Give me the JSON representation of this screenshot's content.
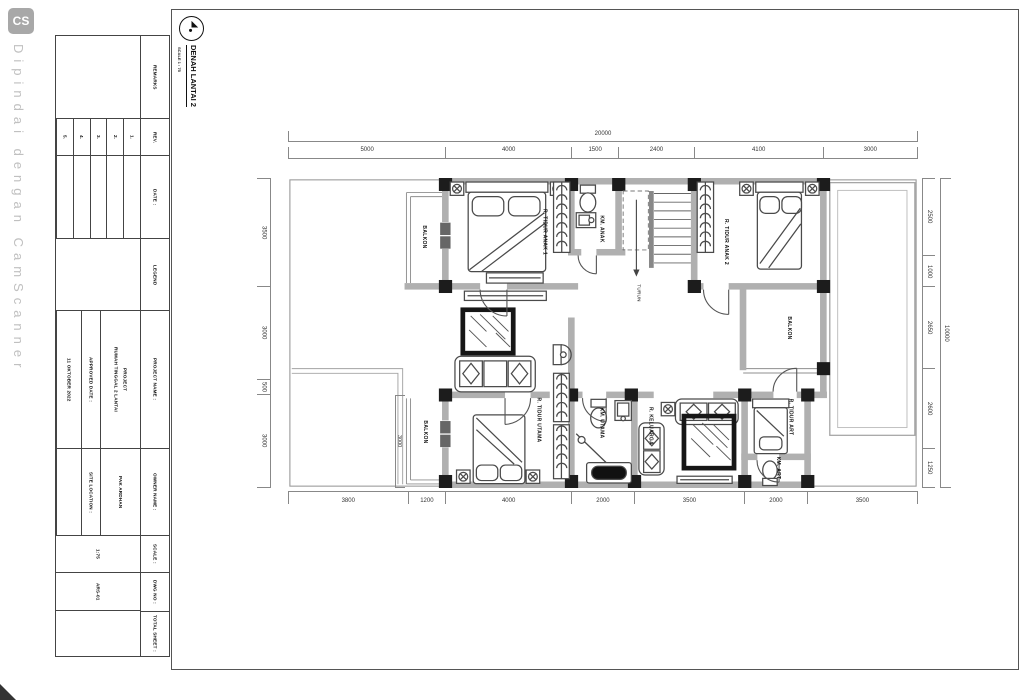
{
  "watermark": {
    "badge": "CS",
    "caption": "Dipindai dengan CamScanner"
  },
  "drawing_header": {
    "title": "DENAH LANTAI 2",
    "scale_note": "SCALE 1 : 75"
  },
  "title_block": {
    "remarks_label": "REMARKS",
    "rev_label": "REV.",
    "rev_numbers": [
      "1.",
      "2.",
      "3.",
      "4.",
      "5."
    ],
    "date_label": "DATE :",
    "legend_label": "LEGEND",
    "project_name_label": "PROJECT NAME :",
    "project_line1": "PROJECT",
    "project_line2": "RUMAH TINGGAL 2 LANTAI",
    "approved_date_label": "APPROVED DATE :",
    "approved_date_value": "11 OKTOBER 2022",
    "owner_name_label": "OWNER NAME :",
    "owner_name_value": "PAK ARDHAN",
    "site_location_label": "SITE LOCATION :",
    "site_location_value": "",
    "scale_label": "SCALE :",
    "scale_value": "1:75",
    "dwg_no_label": "DWG NO :",
    "dwg_no_value": "ARS-01",
    "total_sheet_label": "TOTAL SHEET :",
    "total_sheet_value": ""
  },
  "plan": {
    "dimensions": {
      "top_overall": "20000",
      "top_segments": [
        5000,
        4000,
        1500,
        2400,
        4100,
        3000
      ],
      "bottom_segments": [
        3800,
        1200,
        4000,
        2000,
        3500,
        2000,
        3500
      ],
      "left_segments": [
        3500,
        3000,
        500,
        3000
      ],
      "right_segments": [
        2500,
        1000,
        2650,
        2600,
        1250
      ],
      "right_overall": "10000",
      "inner_dim": "3000"
    },
    "rooms": [
      {
        "name": "BALKON",
        "x": 4320,
        "y": 1900
      },
      {
        "name": "R. TIDUR ANAK 1",
        "x": 8150,
        "y": 1750
      },
      {
        "name": "KM. ANAK",
        "x": 9950,
        "y": 1650
      },
      {
        "name": "R. TIDUR ANAK 2",
        "x": 13900,
        "y": 2050
      },
      {
        "name": "TURUN",
        "x": 11150,
        "y": 3700,
        "small": true
      },
      {
        "name": "BALKON",
        "x": 15900,
        "y": 4850
      },
      {
        "name": "BALKON",
        "x": 4350,
        "y": 8200
      },
      {
        "name": "R. TIDUR UTAMA",
        "x": 7950,
        "y": 7800
      },
      {
        "name": "KM. UTAMA",
        "x": 9950,
        "y": 7900
      },
      {
        "name": "R. KELUARGA",
        "x": 11500,
        "y": 8000
      },
      {
        "name": "R. TIDUR ART",
        "x": 15950,
        "y": 7700
      },
      {
        "name": "KM. ART",
        "x": 15550,
        "y": 9350
      }
    ]
  }
}
